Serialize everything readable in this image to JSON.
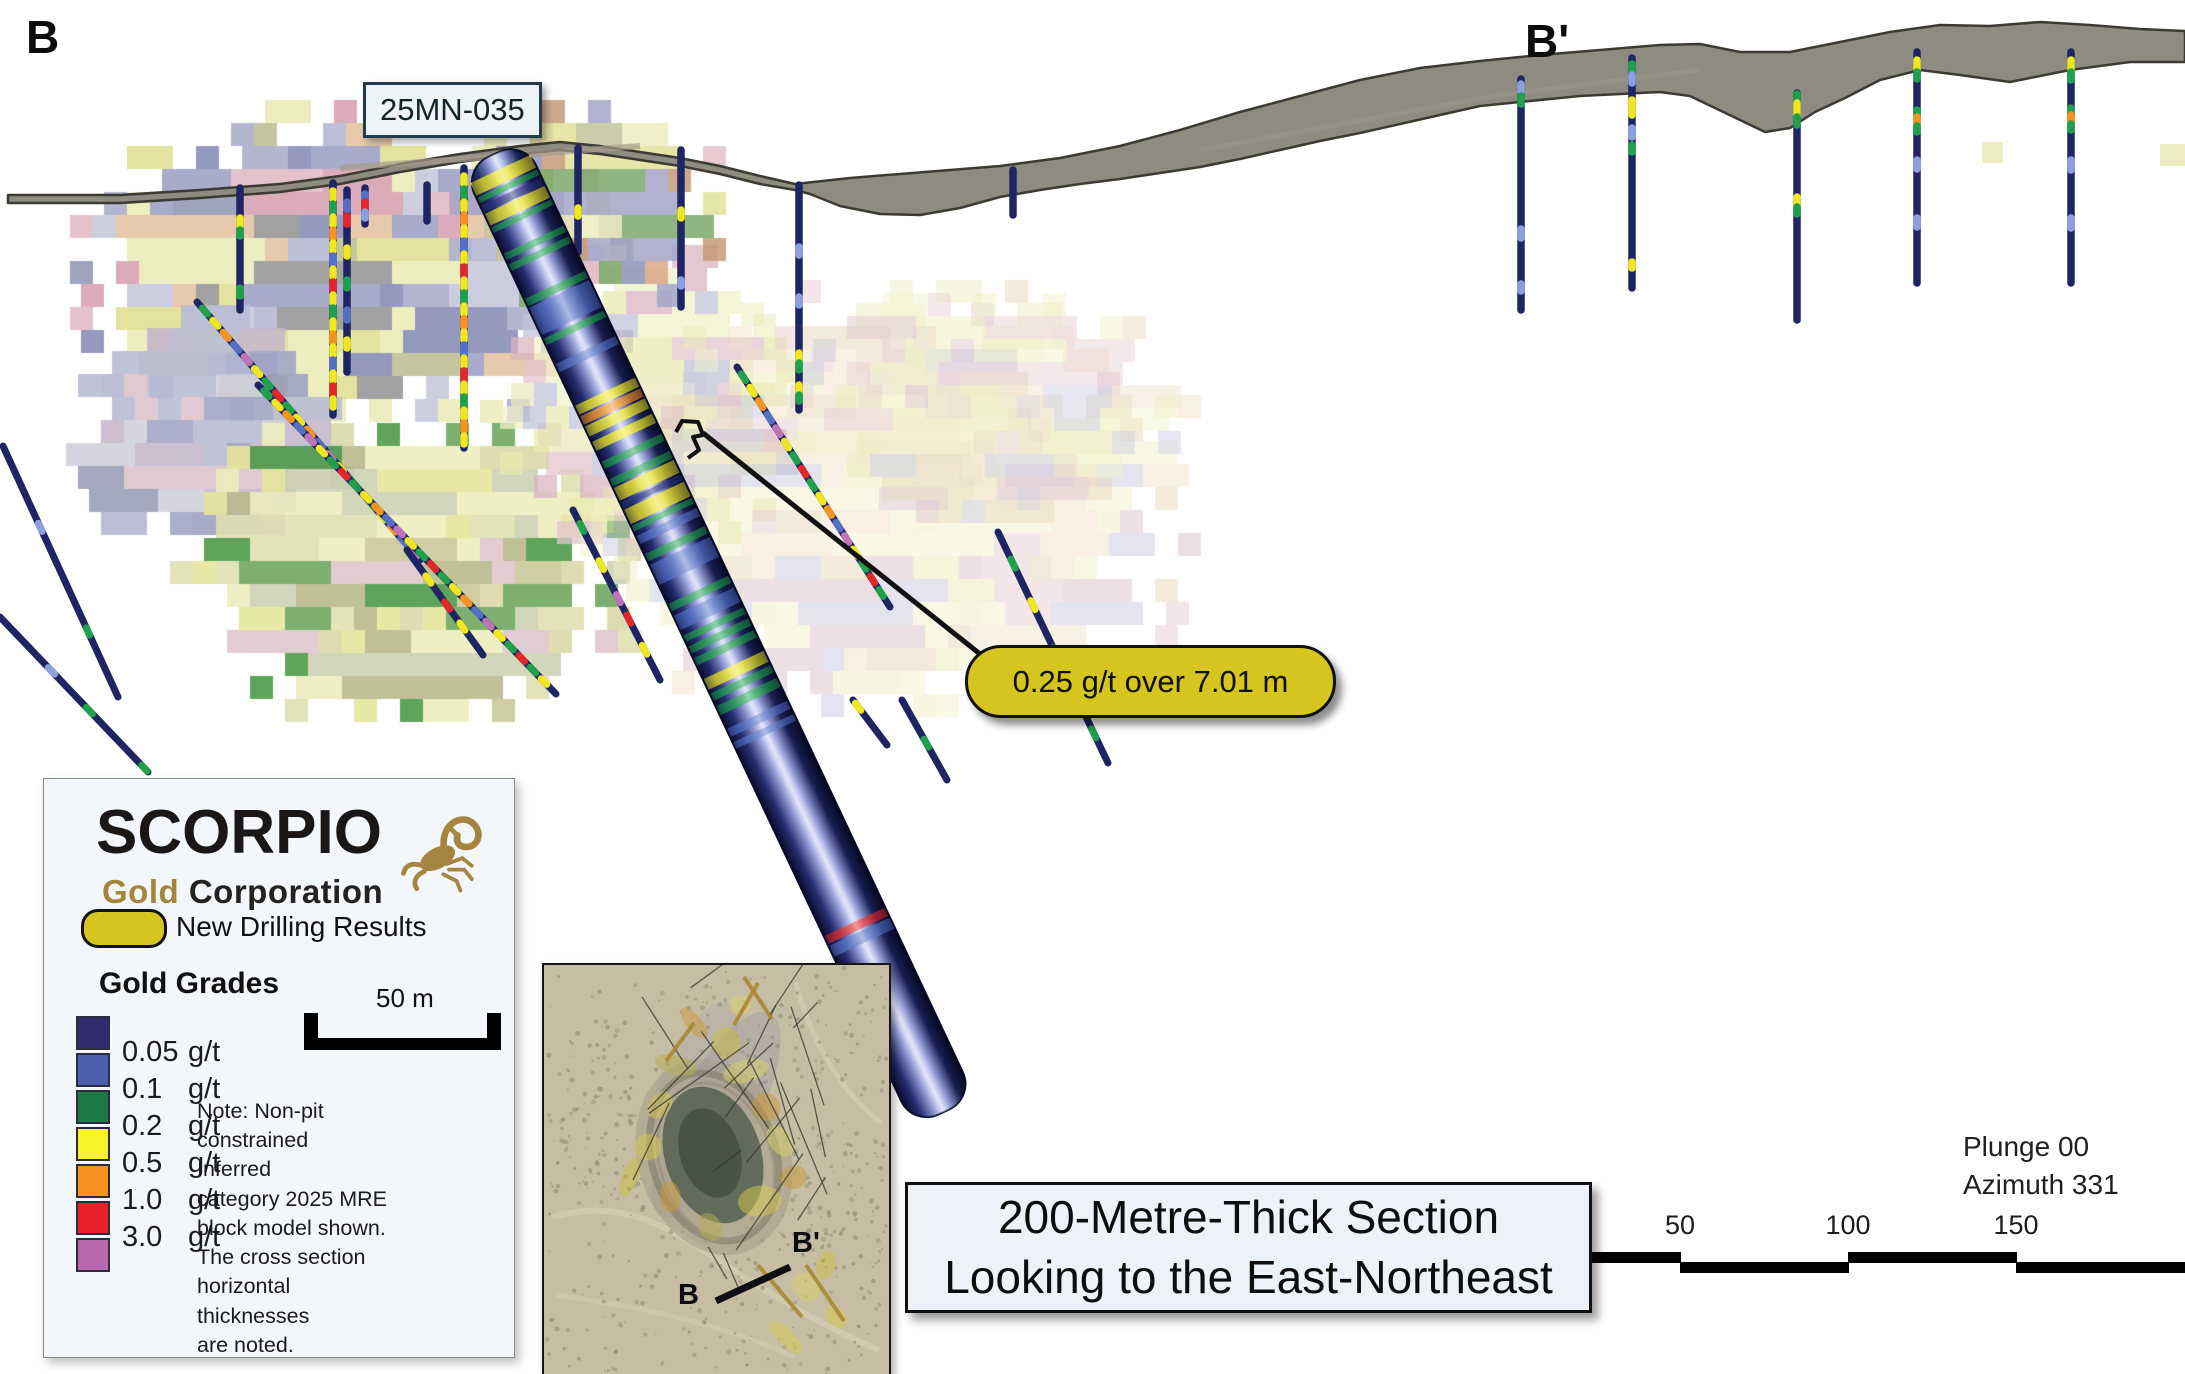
{
  "section": {
    "left_label": "B",
    "right_label": "B'",
    "hole_id": "25MN-035",
    "callout": "0.25 g/t over 7.01 m",
    "title_lines": [
      "200-Metre-Thick Section",
      "Looking to the East-Northeast"
    ],
    "view": {
      "plunge": "Plunge 00",
      "azimuth": "Azimuth 331"
    },
    "ruler_labels": [
      "50",
      "100",
      "150"
    ]
  },
  "legend": {
    "logo": {
      "name": "SCORPIO",
      "subtitle_gold": "Gold",
      "subtitle_rest": " Corporation"
    },
    "new_drilling": "New Drilling Results",
    "grades_title": "Gold Grades",
    "grades": [
      {
        "value": "0.05",
        "unit": "g/t",
        "color": "#312a6b"
      },
      {
        "value": "0.1",
        "unit": "g/t",
        "color": "#4a5fae"
      },
      {
        "value": "0.2",
        "unit": "g/t",
        "color": "#1d7a44"
      },
      {
        "value": "0.5",
        "unit": "g/t",
        "color": "#f8f32b"
      },
      {
        "value": "1.0",
        "unit": "g/t",
        "color": "#f79420"
      },
      {
        "value": "3.0",
        "unit": "g/t",
        "color": "#e8202c"
      }
    ],
    "extra_swatch_color": "#b768ae",
    "scale_bar_label": "50 m",
    "note_lines": [
      "Note: Non-pit",
      "constrained Inferred",
      "category 2025 MRE",
      "block model shown.",
      "The cross section",
      "horizontal thicknesses",
      "are noted."
    ],
    "callout_color": "#d6c41f"
  },
  "inset": {
    "b_label": "B",
    "b_prime_label": "B'"
  }
}
